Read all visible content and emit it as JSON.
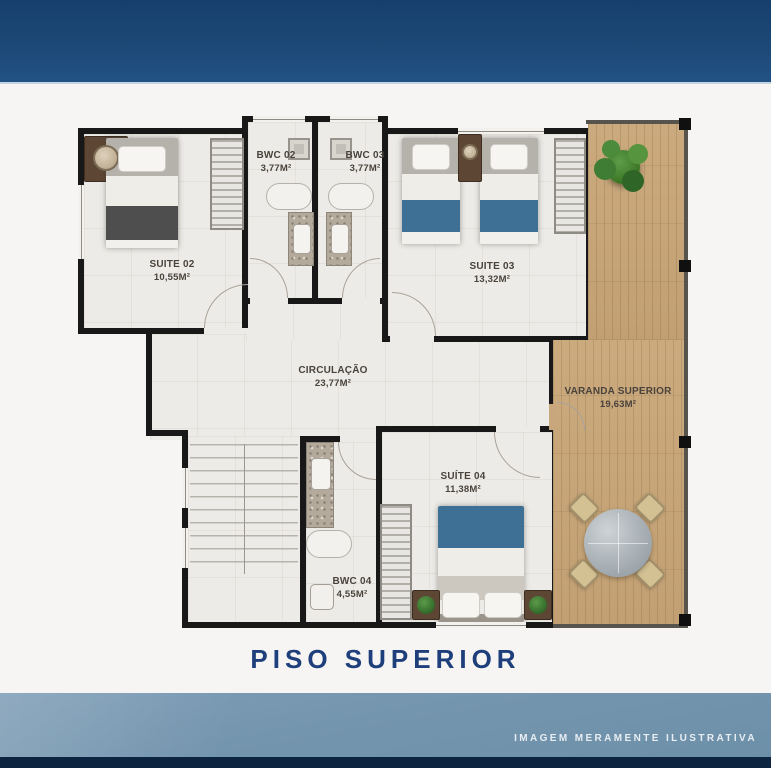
{
  "title": "PISO SUPERIOR",
  "disclaimer": "IMAGEM MERAMENTE ILUSTRATIVA",
  "rooms": {
    "suite02": {
      "name": "SUITE 02",
      "area": "10,55M²"
    },
    "bwc02": {
      "name": "BWC 02",
      "area": "3,77M²"
    },
    "bwc03": {
      "name": "BWC 03",
      "area": "3,77M²"
    },
    "suite03": {
      "name": "SUITE 03",
      "area": "13,32M²"
    },
    "circulacao": {
      "name": "CIRCULAÇÃO",
      "area": "23,77M²"
    },
    "varanda": {
      "name": "VARANDA SUPERIOR",
      "area": "19,63M²"
    },
    "suite04": {
      "name": "SUÍTE 04",
      "area": "11,38M²"
    },
    "bwc04": {
      "name": "BWC 04",
      "area": "4,55M²"
    }
  },
  "furniture": {
    "suite02": [
      "single-bed",
      "nightstand",
      "table-lamp",
      "wardrobe"
    ],
    "suite03": [
      "single-bed",
      "single-bed",
      "nightstand",
      "table-lamp",
      "wardrobe"
    ],
    "suite04": [
      "double-bed",
      "nightstand",
      "nightstand",
      "potted-plant",
      "wardrobe"
    ],
    "bwc02": [
      "shower-fixture",
      "bathtub",
      "vanity-sink"
    ],
    "bwc03": [
      "shower-fixture",
      "bathtub",
      "vanity-sink"
    ],
    "bwc04": [
      "vanity-sink",
      "bathtub",
      "toilet"
    ],
    "circulacao": [
      "staircase"
    ],
    "varanda": [
      "potted-plant",
      "round-table",
      "chair",
      "chair",
      "chair",
      "chair"
    ]
  },
  "colors": {
    "header_navy": "#1c4876",
    "title_navy": "#1e3f7b",
    "sky_band": "#7495ae",
    "bottom_strip": "#0d2440",
    "wall_black": "#181818",
    "floor": "#edebe7",
    "wood_deck": "#c8a77c",
    "blanket_blue": "#3e7095",
    "blanket_dark": "#4e4e4e",
    "plant_green": "#3e7d33"
  }
}
